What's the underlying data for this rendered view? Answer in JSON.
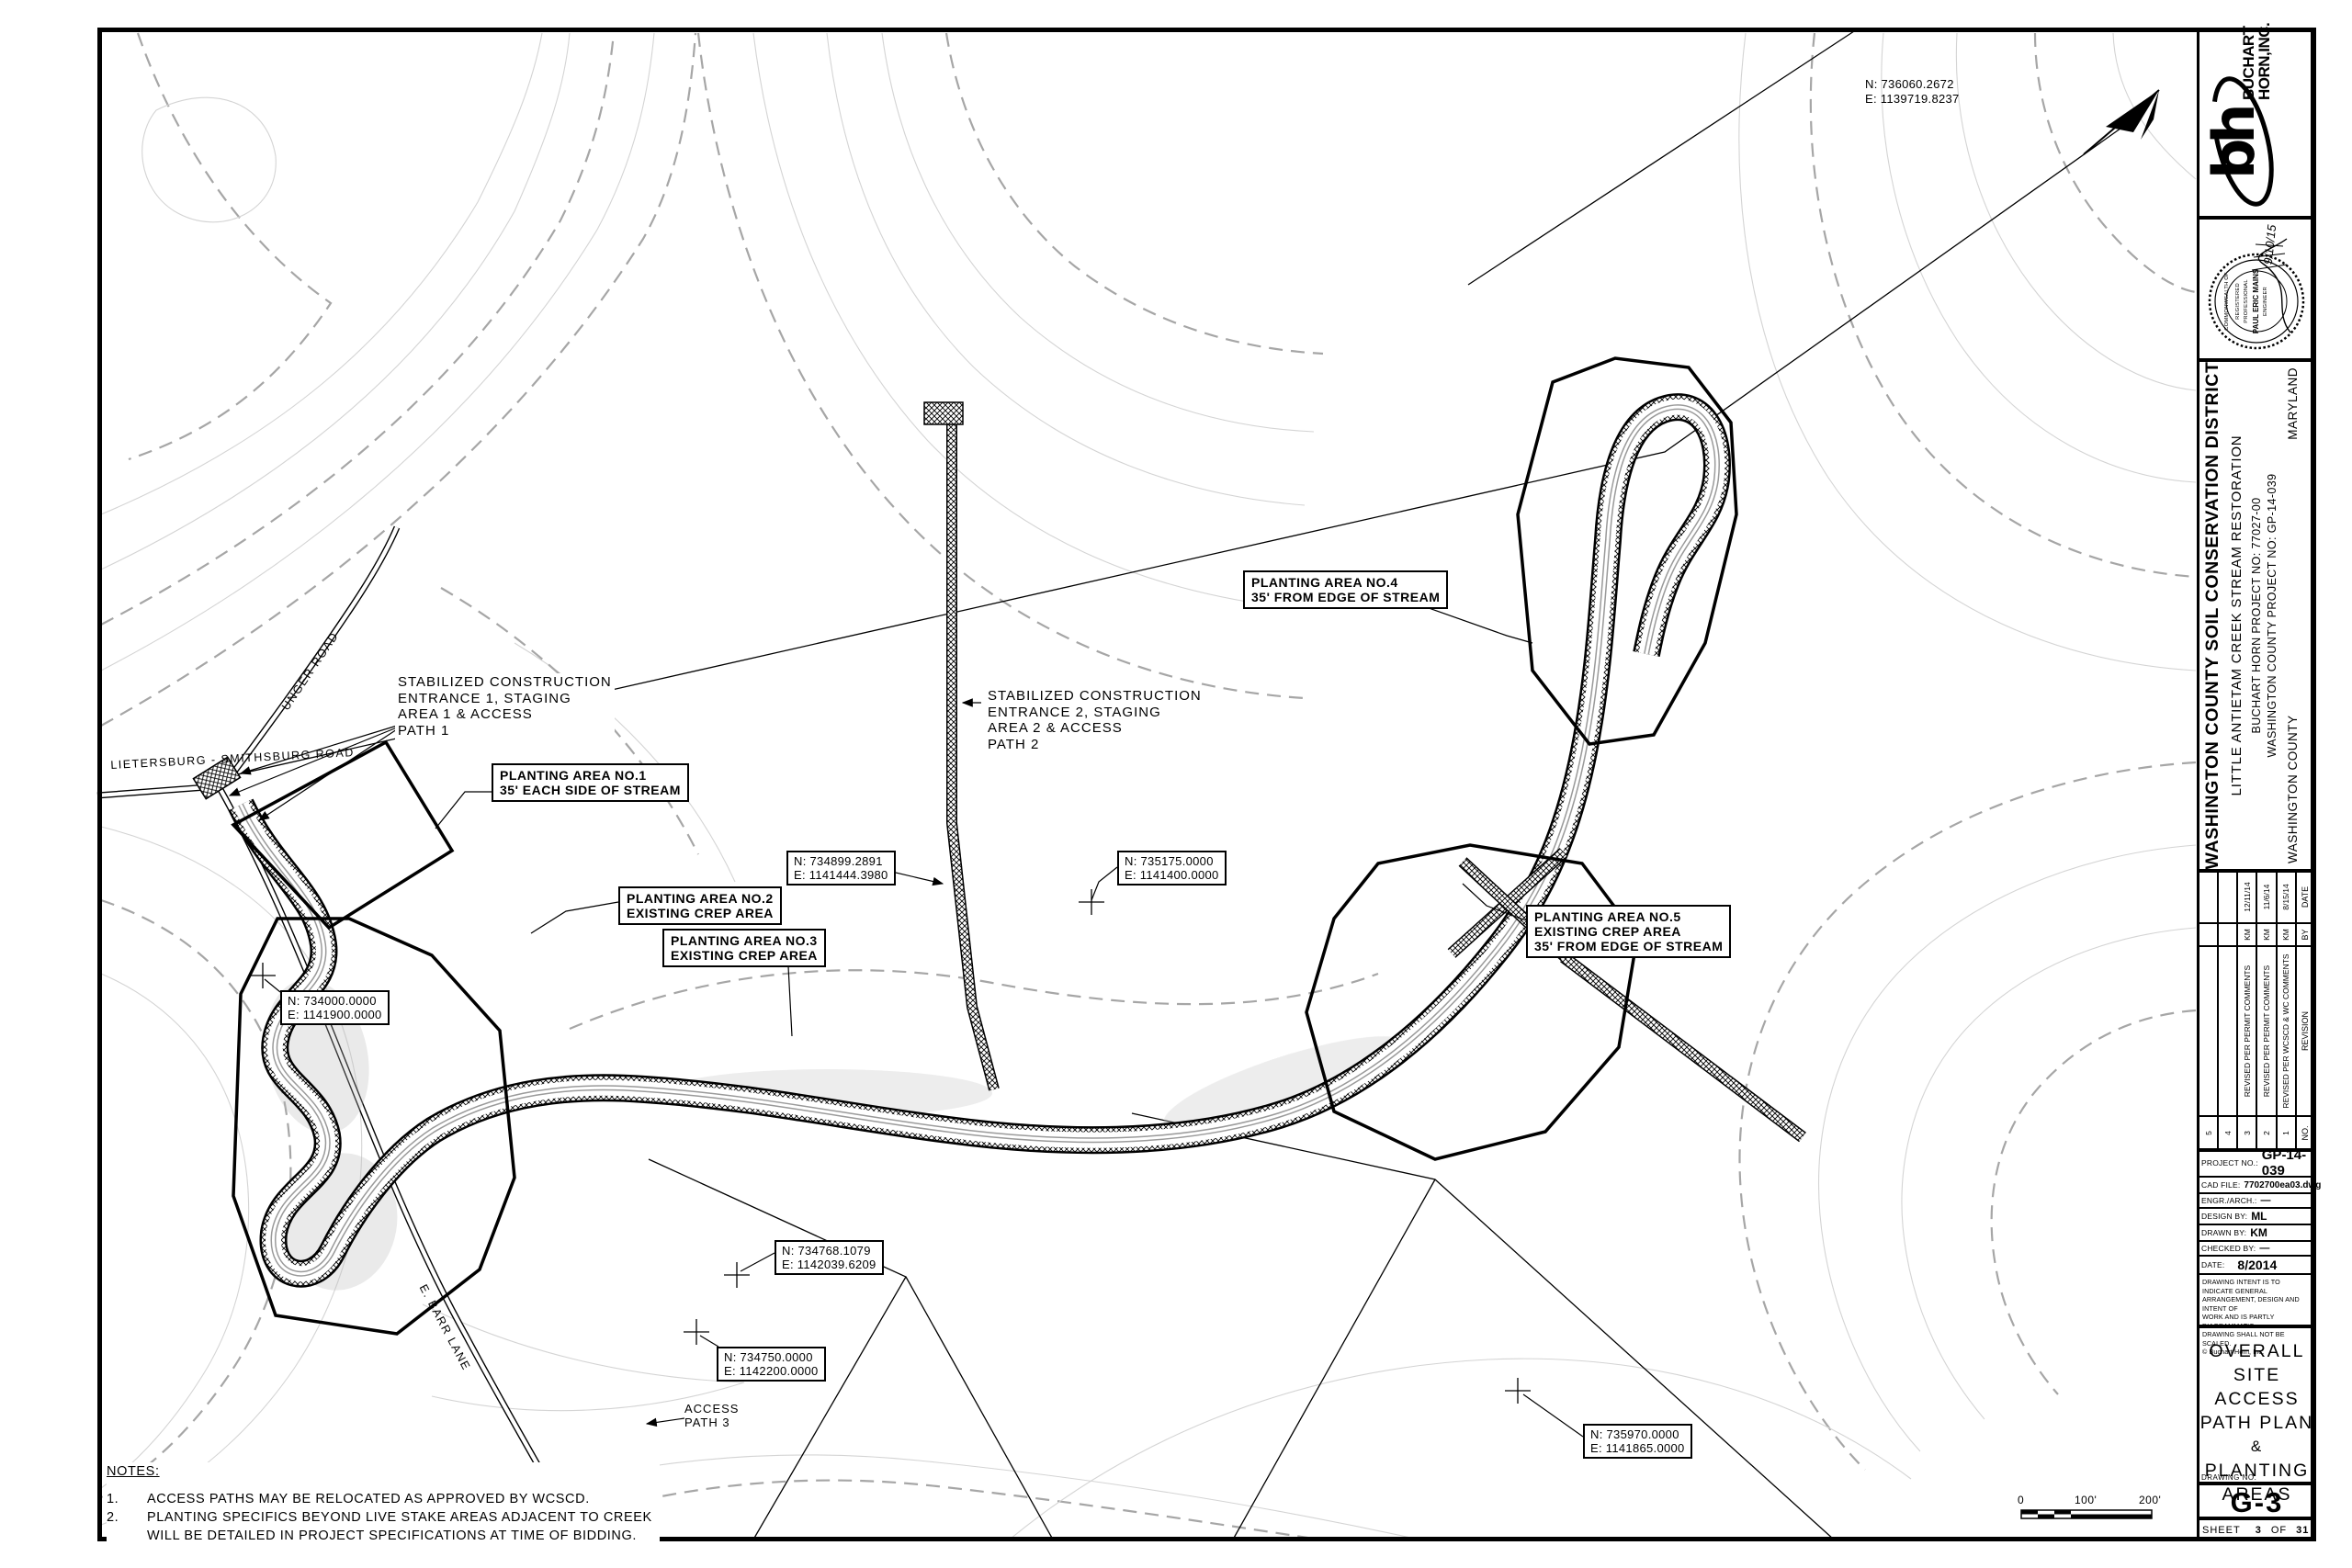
{
  "colors": {
    "line": "#000000",
    "contour_light": "#d4d4d4",
    "contour_index": "#a6a6a6"
  },
  "map": {
    "coords": [
      {
        "n": "N: 736060.2672",
        "e": "E: 1139719.8237"
      },
      {
        "n": "N: 734899.2891",
        "e": "E: 1141444.3980"
      },
      {
        "n": "N: 735175.0000",
        "e": "E: 1141400.0000"
      },
      {
        "n": "N: 734000.0000",
        "e": "E: 1141900.0000"
      },
      {
        "n": "N: 734768.1079",
        "e": "E: 1142039.6209"
      },
      {
        "n": "N: 734750.0000",
        "e": "E: 1142200.0000"
      },
      {
        "n": "N: 735970.0000",
        "e": "E: 1141865.0000"
      }
    ],
    "callouts": {
      "sce1": {
        "l1": "STABILIZED CONSTRUCTION",
        "l2": "ENTRANCE 1, STAGING",
        "l3": "AREA 1 & ACCESS",
        "l4": "PATH 1"
      },
      "sce2": {
        "l1": "STABILIZED CONSTRUCTION",
        "l2": "ENTRANCE 2, STAGING",
        "l3": "AREA 2 & ACCESS",
        "l4": "PATH 2"
      },
      "pa1": {
        "l1": "PLANTING AREA NO.1",
        "l2": "35' EACH SIDE OF STREAM"
      },
      "pa2": {
        "l1": "PLANTING AREA NO.2",
        "l2": "EXISTING CREP AREA"
      },
      "pa3": {
        "l1": "PLANTING AREA NO.3",
        "l2": "EXISTING CREP AREA"
      },
      "pa4": {
        "l1": "PLANTING AREA NO.4",
        "l2": "35' FROM EDGE OF STREAM"
      },
      "pa5": {
        "l1": "PLANTING AREA NO.5",
        "l2": "EXISTING CREP AREA",
        "l3": "35' FROM EDGE OF STREAM"
      }
    },
    "roads": {
      "lietersburg": "LIETERSBURG - SMITHSBURG ROAD",
      "unger": "UNGER ROAD",
      "barr": "E. BARR LANE",
      "access3_l1": "ACCESS",
      "access3_l2": "PATH 3"
    },
    "notes": {
      "title": "NOTES:",
      "n1": "1.",
      "n1_text": "ACCESS PATHS MAY BE RELOCATED AS APPROVED BY WCSCD.",
      "n2": "2.",
      "n2_line1": "PLANTING SPECIFICS BEYOND LIVE STAKE AREAS ADJACENT TO CREEK",
      "n2_line2": "WILL BE DETAILED IN PROJECT SPECIFICATIONS AT TIME OF BIDDING."
    },
    "scalebar": {
      "zero": "0",
      "mid": "100'",
      "end": "200'"
    }
  },
  "titleblock": {
    "firm": {
      "name1": "BUCHART",
      "name2": "HORN,INC.",
      "monogram": "bh"
    },
    "stamp": {
      "arc": "COMMONWEALTH OF",
      "registered": "REGISTERED",
      "professional": "PROFESSIONAL",
      "name": "PAUL ERIC MAINS",
      "engineer": "ENGINEER",
      "date": "9/10/15"
    },
    "project": {
      "district": "WASHINGTON COUNTY SOIL CONSERVATION DISTRICT",
      "title": "LITTLE ANTIETAM CREEK STREAM RESTORATION",
      "bh_no": "BUCHART HORN PROJECT NO: 77027-00",
      "county_no": "WASHINGTON COUNTY PROJECT NO: GP-14-039",
      "county": "WASHINGTON COUNTY",
      "state": "MARYLAND"
    },
    "revisions": {
      "headers": {
        "no": "NO.",
        "revision": "REVISION",
        "by": "BY",
        "date": "DATE"
      },
      "rows": [
        {
          "no": "5",
          "revision": "",
          "by": "",
          "date": ""
        },
        {
          "no": "4",
          "revision": "",
          "by": "",
          "date": ""
        },
        {
          "no": "3",
          "revision": "REVISED PER PERMIT COMMENTS",
          "by": "KM",
          "date": "12/11/14"
        },
        {
          "no": "2",
          "revision": "REVISED PER PERMIT COMMENTS",
          "by": "KM",
          "date": "11/6/14"
        },
        {
          "no": "1",
          "revision": "REVISED PER WCSCD & WC COMMENTS",
          "by": "KM",
          "date": "8/15/14"
        }
      ]
    },
    "info": {
      "project_no_label": "PROJECT NO.:",
      "project_no": "GP-14-039",
      "cad_label": "CAD FILE:",
      "cad": "7702700ea03.dwg",
      "engr_label": "ENGR./ARCH.:",
      "engr": "—",
      "design_label": "DESIGN BY:",
      "design": "ML",
      "drawn_label": "DRAWN BY:",
      "drawn": "KM",
      "checked_label": "CHECKED BY:",
      "checked": "—",
      "date_label": "DATE:",
      "date": "8/2014",
      "disc1": "DRAWING INTENT IS TO INDICATE GENERAL",
      "disc2": "ARRANGEMENT, DESIGN AND INTENT OF",
      "disc3": "WORK AND IS PARTLY DIAGRAMMATIC.",
      "disc4": "DRAWING SHALL NOT BE SCALED.",
      "disc5": "© Buchart Horn, Inc."
    },
    "sheet": {
      "t1": "OVERALL",
      "t2": "SITE ACCESS",
      "t3": "PATH PLAN",
      "t4": "&",
      "t5": "PLANTING",
      "t6": "AREAS",
      "drawing_no_label": "DRAWING NO.",
      "drawing_no": "G-3",
      "sheet_label": "SHEET",
      "sheet_no": "3",
      "of": "OF",
      "total": "31"
    }
  }
}
